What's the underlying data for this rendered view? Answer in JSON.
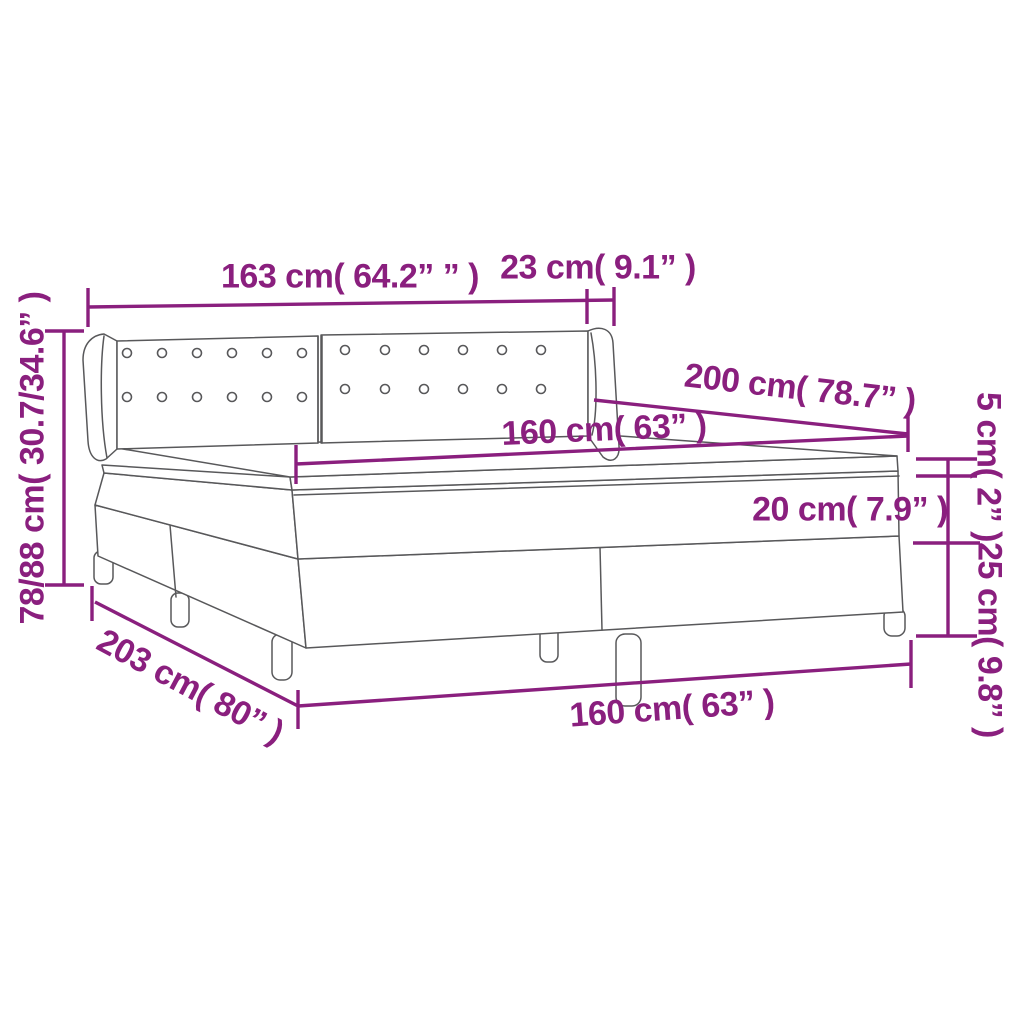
{
  "diagram": {
    "title": "box-spring-bed-dimension-diagram",
    "colors": {
      "accent": "#8A1F7E",
      "line_art": "#58585A",
      "background": "#FFFFFF"
    },
    "labels": {
      "headboard_width": "163 cm( 64.2” ” )",
      "wing_depth": "23 cm( 9.1” )",
      "headboard_height": "78/88 cm( 30.7/34.6” )",
      "bed_length_top": "200 cm( 78.7” )",
      "mattress_width_top": "160 cm( 63” )",
      "topper_height": "5 cm( 2” )",
      "mattress_height": "20 cm( 7.9” )",
      "base_height": "25 cm( 9.8” )",
      "bed_length_bottom": "203 cm( 80” )",
      "bed_width_bottom": "160 cm( 63” )"
    }
  }
}
